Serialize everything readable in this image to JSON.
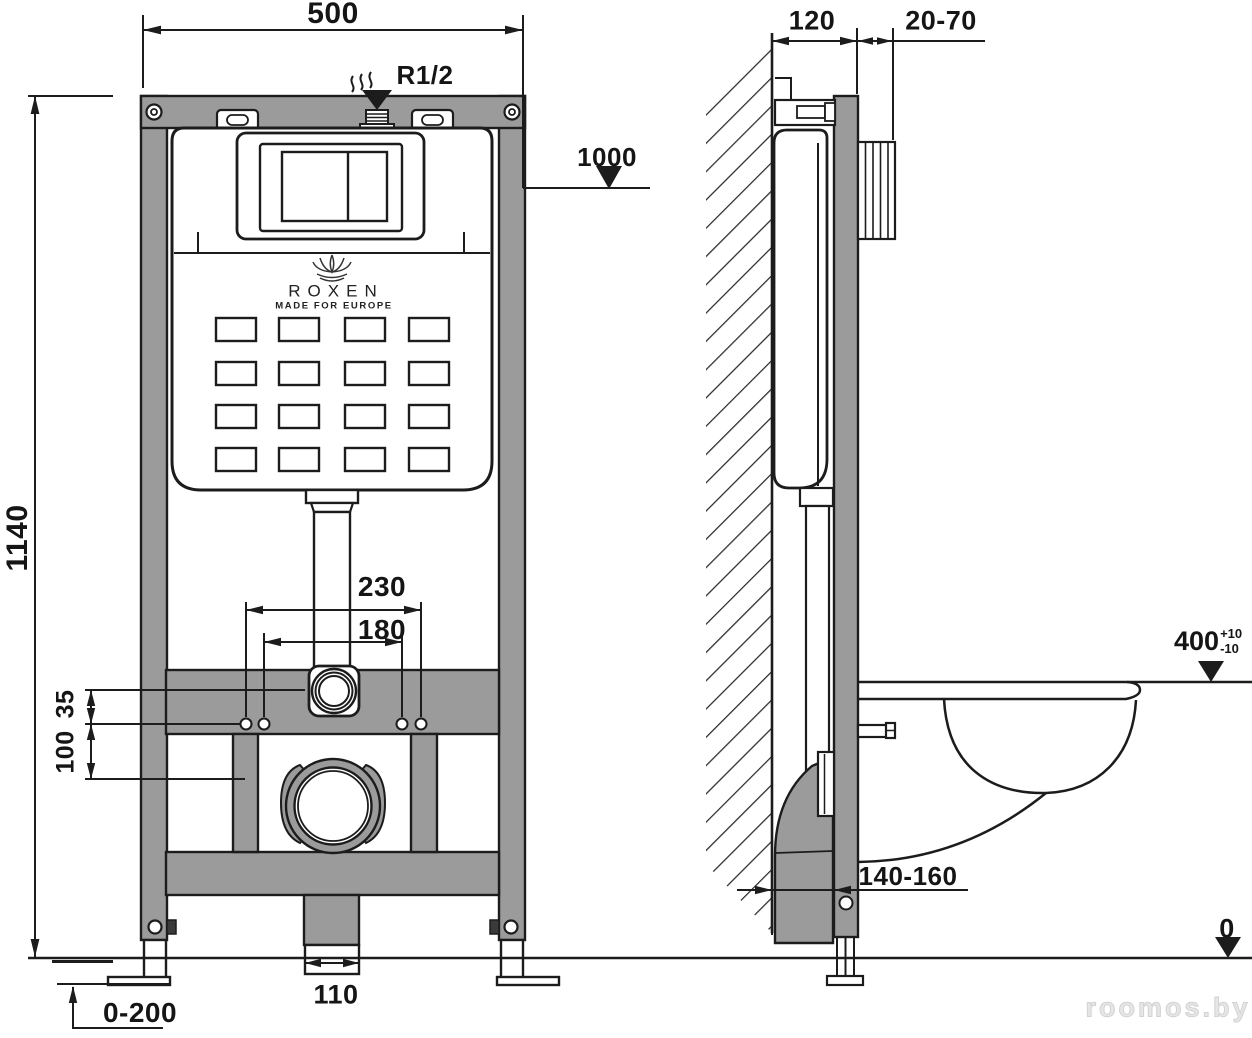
{
  "drawing": {
    "title_brand": "ROXEN",
    "tagline": "MADE FOR EUROPE",
    "watermark": "roomos.by",
    "colors": {
      "frame_gray": "#9b9b9b",
      "line_black": "#1c1c1c",
      "watermark_gray": "#e6e6e6"
    },
    "dimensions": {
      "frame_width": "500",
      "inlet_thread": "R1/2",
      "button_height": "1000",
      "frame_height": "1140",
      "outer_hole_spacing": "230",
      "inner_hole_spacing": "180",
      "offset_small": "35",
      "offset_large": "100",
      "drain_leg_width": "110",
      "leg_adjustment": "0-200",
      "frame_depth": "120",
      "cladding_thickness": "20-70",
      "seat_height": "400",
      "seat_tol_plus": "+10",
      "seat_tol_minus": "-10",
      "outlet_offset": "140-160",
      "floor_level": "0"
    }
  }
}
